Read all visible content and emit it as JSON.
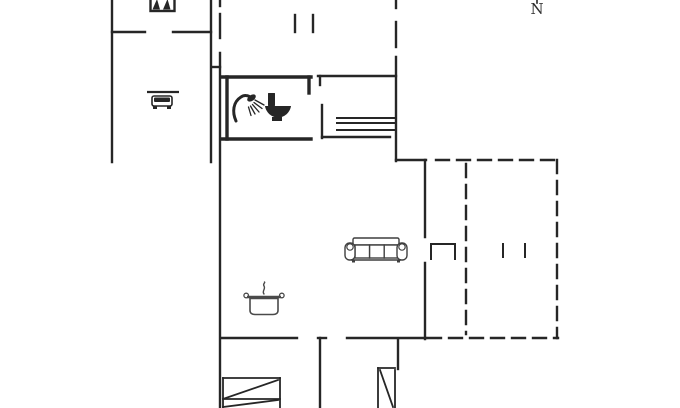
{
  "compass": {
    "label": "N"
  },
  "colors": {
    "wall": "#262626",
    "furniture_outline": "#3f3f3f",
    "pot_outline": "#4a4a4a",
    "background": "#ffffff"
  },
  "floorplan": {
    "walls": [
      [
        112,
        0,
        112,
        162
      ],
      [
        211,
        0,
        211,
        162
      ],
      [
        112,
        32,
        145,
        32
      ],
      [
        173,
        32,
        211,
        32
      ],
      [
        220,
        0,
        220,
        6
      ],
      [
        220,
        14,
        220,
        38
      ],
      [
        220,
        53,
        220,
        408
      ],
      [
        212,
        67,
        220,
        67
      ],
      [
        295,
        15,
        295,
        32
      ],
      [
        313,
        15,
        313,
        32
      ],
      [
        396,
        0,
        396,
        8
      ],
      [
        396,
        22,
        396,
        47
      ],
      [
        396,
        57,
        396,
        161
      ],
      [
        396,
        160,
        426,
        160
      ],
      [
        425,
        160,
        425,
        237
      ],
      [
        425,
        263,
        425,
        339
      ],
      [
        318,
        76,
        396,
        76
      ],
      [
        320,
        76,
        320,
        85
      ],
      [
        322,
        105,
        322,
        138
      ],
      [
        322,
        137,
        390,
        137
      ],
      [
        221,
        338,
        297,
        338
      ],
      [
        318,
        338,
        326,
        338
      ],
      [
        320,
        338,
        320,
        408
      ],
      [
        347,
        338,
        426,
        338
      ],
      [
        398,
        340,
        398,
        369
      ]
    ],
    "thick_walls": [
      [
        221,
        77,
        311,
        77
      ],
      [
        309,
        77,
        309,
        93
      ],
      [
        227,
        77,
        227,
        139
      ],
      [
        221,
        139,
        311,
        139
      ]
    ],
    "stair_lines": [
      [
        337,
        118,
        395,
        118
      ],
      [
        337,
        123,
        395,
        123
      ],
      [
        337,
        130,
        395,
        130
      ]
    ],
    "bed_lines": [
      [
        223,
        378,
        280,
        378
      ],
      [
        280,
        378,
        280,
        408
      ],
      [
        223,
        378,
        223,
        408
      ],
      [
        223,
        399,
        280,
        399
      ],
      [
        223,
        399,
        278,
        380
      ],
      [
        223,
        407,
        278,
        400
      ],
      [
        378,
        368,
        395,
        368
      ],
      [
        378,
        368,
        378,
        408
      ],
      [
        395,
        370,
        395,
        408
      ],
      [
        380,
        370,
        393,
        407
      ]
    ],
    "dashed_walls": [
      [
        436,
        160,
        558,
        160
      ],
      [
        557,
        160,
        557,
        338
      ],
      [
        428,
        338,
        558,
        338
      ],
      [
        466,
        164,
        466,
        334
      ]
    ],
    "terrace_marks": [
      [
        431,
        259,
        431,
        244
      ],
      [
        431,
        244,
        455,
        244
      ],
      [
        455,
        244,
        455,
        259
      ],
      [
        503,
        244,
        503,
        257
      ],
      [
        525,
        244,
        525,
        257
      ]
    ],
    "compass_tick": [
      537,
      0,
      537,
      3
    ],
    "icons": [
      {
        "name": "bunk-bed-icon",
        "x": 150,
        "y": 0
      },
      {
        "name": "car-icon",
        "x": 147,
        "y": 90
      },
      {
        "name": "shower-icon",
        "x": 233,
        "y": 93
      },
      {
        "name": "toilet-icon",
        "x": 265,
        "y": 92
      },
      {
        "name": "sofa-icon",
        "x": 345,
        "y": 237
      },
      {
        "name": "cooking-pot-icon",
        "x": 245,
        "y": 282
      }
    ]
  }
}
